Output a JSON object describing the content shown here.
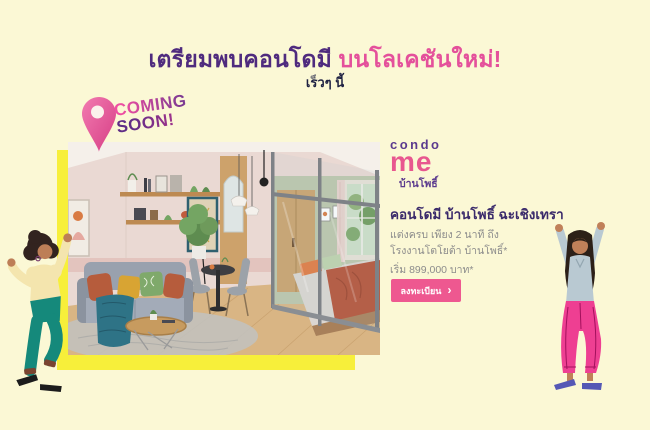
{
  "page": {
    "width": 650,
    "height": 430
  },
  "header": {
    "title_main": "เตรียมพบคอนโดมี ",
    "title_accent": "บนโลเคชันใหม่!",
    "subtitle": "เร็วๆ นี้"
  },
  "coming_soon": {
    "line1": "COMING",
    "line2": "SOON!"
  },
  "brand": {
    "word_top": "condo",
    "word_main": "me",
    "project": "บ้านโพธิ์"
  },
  "details": {
    "heading": "คอนโดมี บ้านโพธิ์ ฉะเชิงเทรา",
    "line1": "แต่งครบ เพียง 2 นาที ถึง",
    "line2": "โรงงานโตโยต้า บ้านโพธิ์*",
    "price": "เริ่ม 899,000 บาท*"
  },
  "cta": {
    "label": "ลงทะเบียน",
    "chevron": "›"
  },
  "icons": {
    "pin": "location-pin-icon",
    "chevron": "chevron-right-icon"
  },
  "colors": {
    "background": "#FBF8D5",
    "accent_yellow": "#F7EF3A",
    "brand_pink": "#E8578F",
    "brand_purple": "#4F2B7E",
    "title_accent_pink": "#E4509B",
    "heading_indigo": "#3A2A6B",
    "navy": "#1E2142",
    "text_gray": "#8C8C8C",
    "button_pink": "#EE5890"
  }
}
